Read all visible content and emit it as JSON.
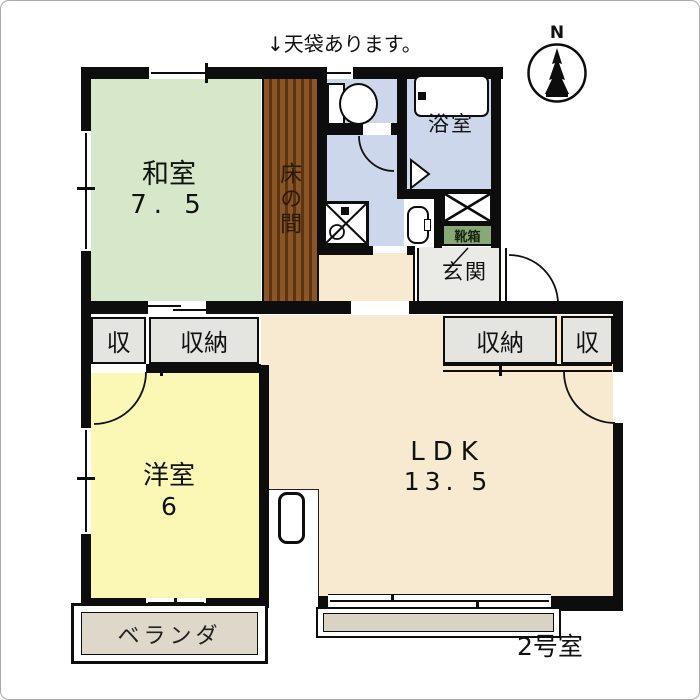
{
  "note": {
    "text": "↓天袋あります。"
  },
  "compass": {
    "label": "N"
  },
  "unit_label": "2号室",
  "rooms": {
    "washitsu": {
      "name": "和室",
      "size": "7. 5"
    },
    "tokonoma": {
      "name": "床の間"
    },
    "bathroom": {
      "name": "浴室"
    },
    "entrance": {
      "name": "玄関"
    },
    "shoe_box": {
      "name": "靴箱"
    },
    "western_room": {
      "name": "洋室",
      "size": "6"
    },
    "ldk": {
      "name": "LDK",
      "size": "13. 5"
    },
    "veranda": {
      "name": "ベランダ"
    }
  },
  "closets": {
    "left_small": "収",
    "left": "収納",
    "right": "収納",
    "right_small": "収"
  },
  "colors": {
    "washitsu_green": "#d7e7c9",
    "water_blue": "#cdd7eb",
    "western_yellow": "#fbf8b6",
    "ldk_beige": "#f8ead1",
    "closet_gray": "#e4e4e1",
    "entrance_gray": "#eaeae7",
    "veranda_gray": "#ddd8c9",
    "balcony_gray": "#d8d3c3",
    "tokonoma_brown": "#8a5527",
    "tokonoma_stripe": "#5c3510",
    "shoebox_green": "#87a877",
    "wall_black": "#0d0d0d"
  }
}
